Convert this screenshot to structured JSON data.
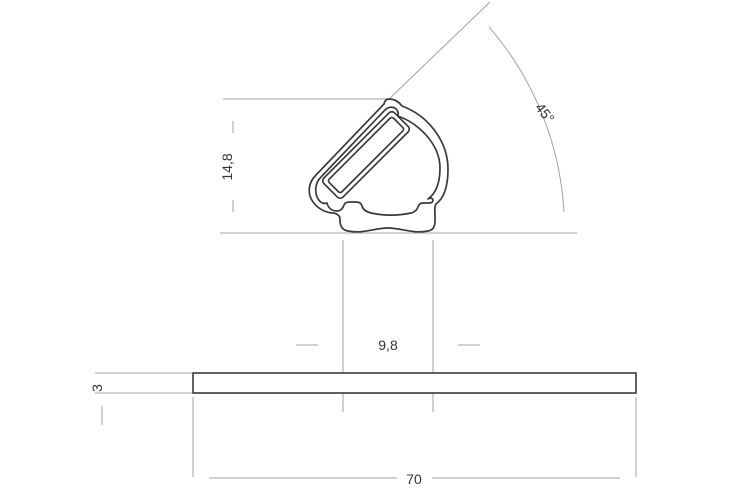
{
  "drawing": {
    "dimensions": {
      "profile_height": {
        "label": "14,8"
      },
      "angle": {
        "label": "45°"
      },
      "slot_width": {
        "label": "9,8"
      },
      "plate_thickness": {
        "label": "3"
      },
      "plate_width": {
        "label": "70"
      }
    },
    "colors": {
      "outline": "#3a3a3a",
      "dimension_lines": "#a3a3a3",
      "label_text": "#333333",
      "background": "#ffffff"
    }
  }
}
